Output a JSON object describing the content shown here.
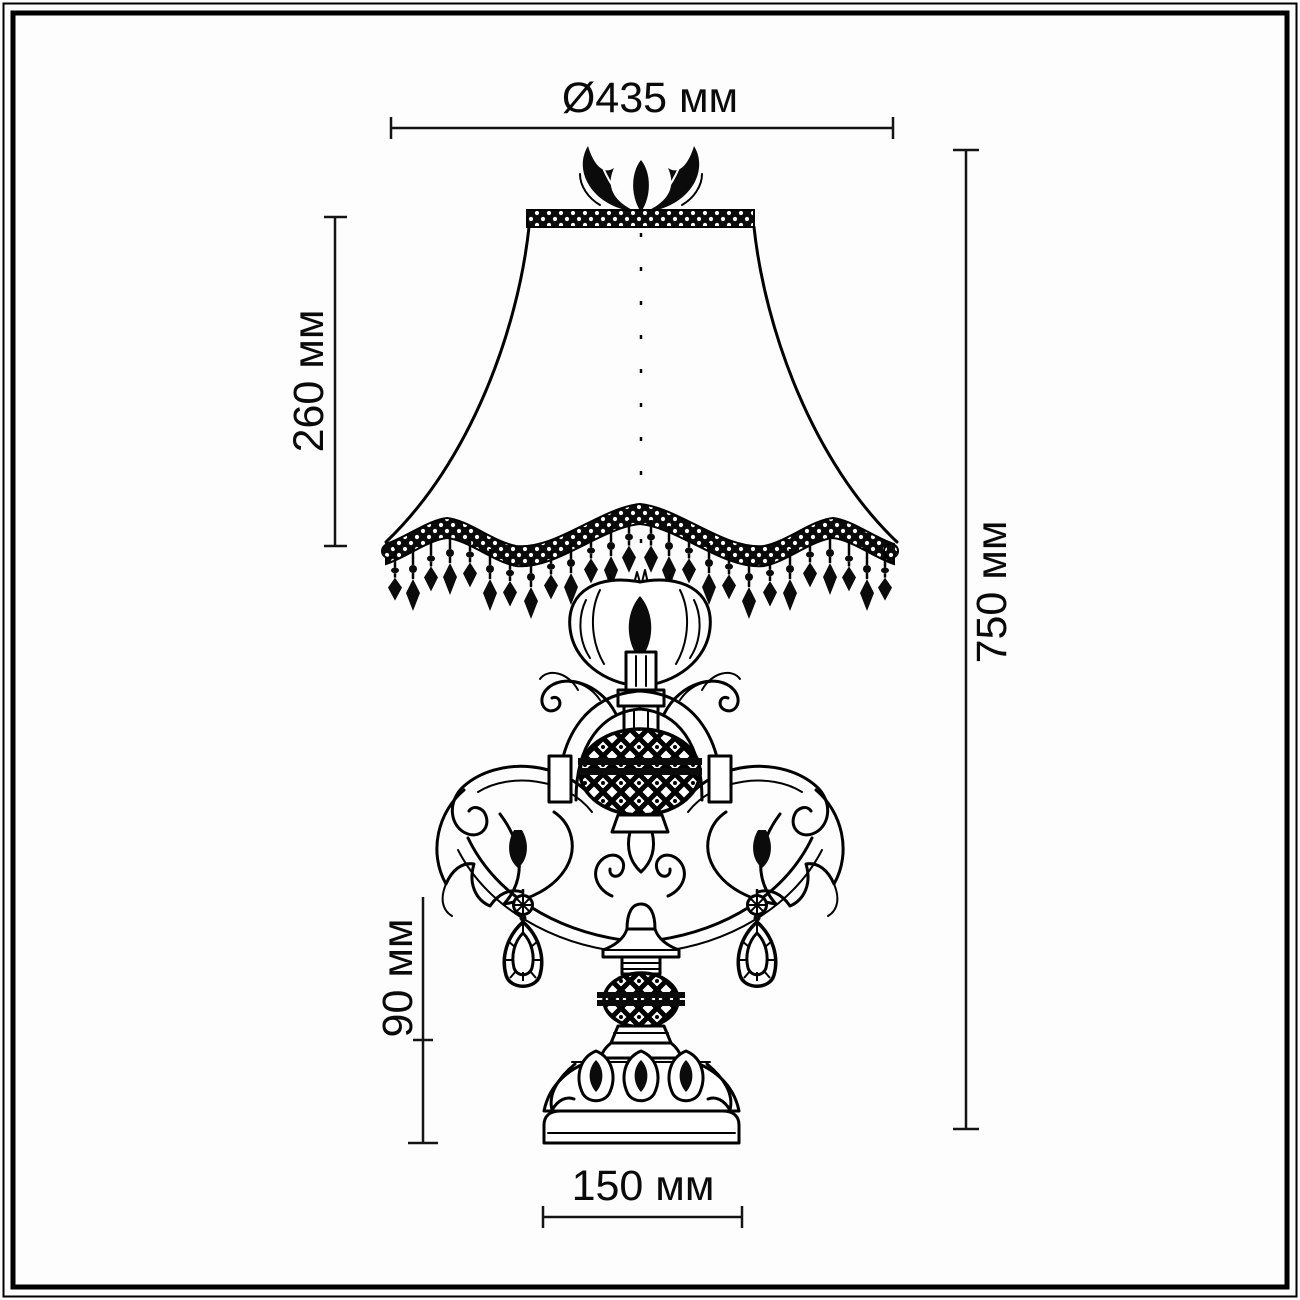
{
  "dimensions": {
    "top_diameter": "Ø435 мм",
    "shade_height": "260 мм",
    "total_height": "750 мм",
    "base_height": "90 мм",
    "base_width": "150 мм"
  },
  "style": {
    "ink_color": "#000000",
    "background": "#fdfdfd"
  }
}
